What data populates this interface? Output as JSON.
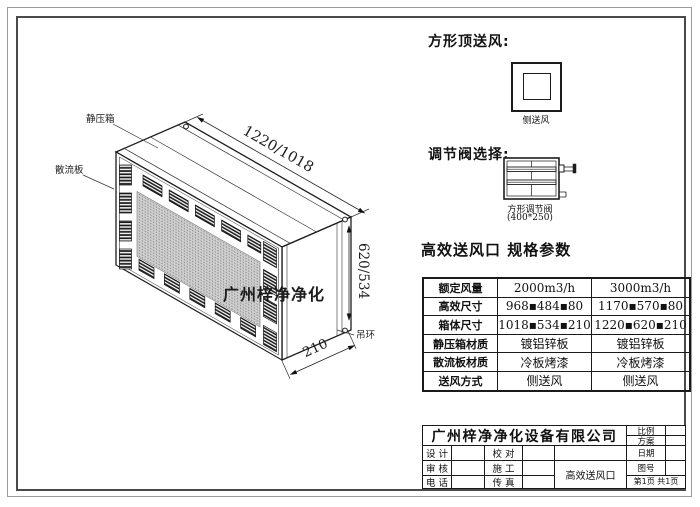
{
  "drawing": {
    "labels": {
      "static_pressure_box": "静压箱",
      "diffuser_plate": "散流板",
      "lifting_ring": "吊环",
      "watermark": "广州梓净净化"
    },
    "dimensions": {
      "width": "1220/1018",
      "height": "620/534",
      "depth": "210"
    }
  },
  "top_supply": {
    "heading": "方形顶送风:",
    "caption": "侧送风"
  },
  "damper": {
    "heading": "调节阀选择:",
    "caption_line1": "方形调节阀",
    "caption_line2": "(400*250)"
  },
  "spec": {
    "title": "高效送风口 规格参数",
    "rows": [
      {
        "label": "额定风量",
        "col1": "2000m3/h",
        "col2": "3000m3/h"
      },
      {
        "label": "高效尺寸",
        "col1": "968▪484▪80",
        "col2": "1170▪570▪80"
      },
      {
        "label": "箱体尺寸",
        "col1": "1018▪534▪210",
        "col2": "1220▪620▪210"
      },
      {
        "label": "静压箱材质",
        "col1": "镀铝锌板",
        "col2": "镀铝锌板"
      },
      {
        "label": "散流板材质",
        "col1": "冷板烤漆",
        "col2": "冷板烤漆"
      },
      {
        "label": "送风方式",
        "col1": "侧送风",
        "col2": "侧送风"
      }
    ]
  },
  "titleblock": {
    "company": "广州梓净净化设备有限公司",
    "fields": {
      "design": "设 计",
      "check": "校 对",
      "review": "审 核",
      "construction": "施 工",
      "phone": "电 话",
      "fax": "传 真",
      "scale": "比例",
      "scheme": "方案",
      "date": "日期",
      "drawing_no": "图号"
    },
    "product": "高效送风口",
    "page": "第1页 共1页"
  },
  "colors": {
    "line": "#1c1c1c",
    "mesh": "#cfcfcf",
    "watermark": "#3a3a3a"
  }
}
